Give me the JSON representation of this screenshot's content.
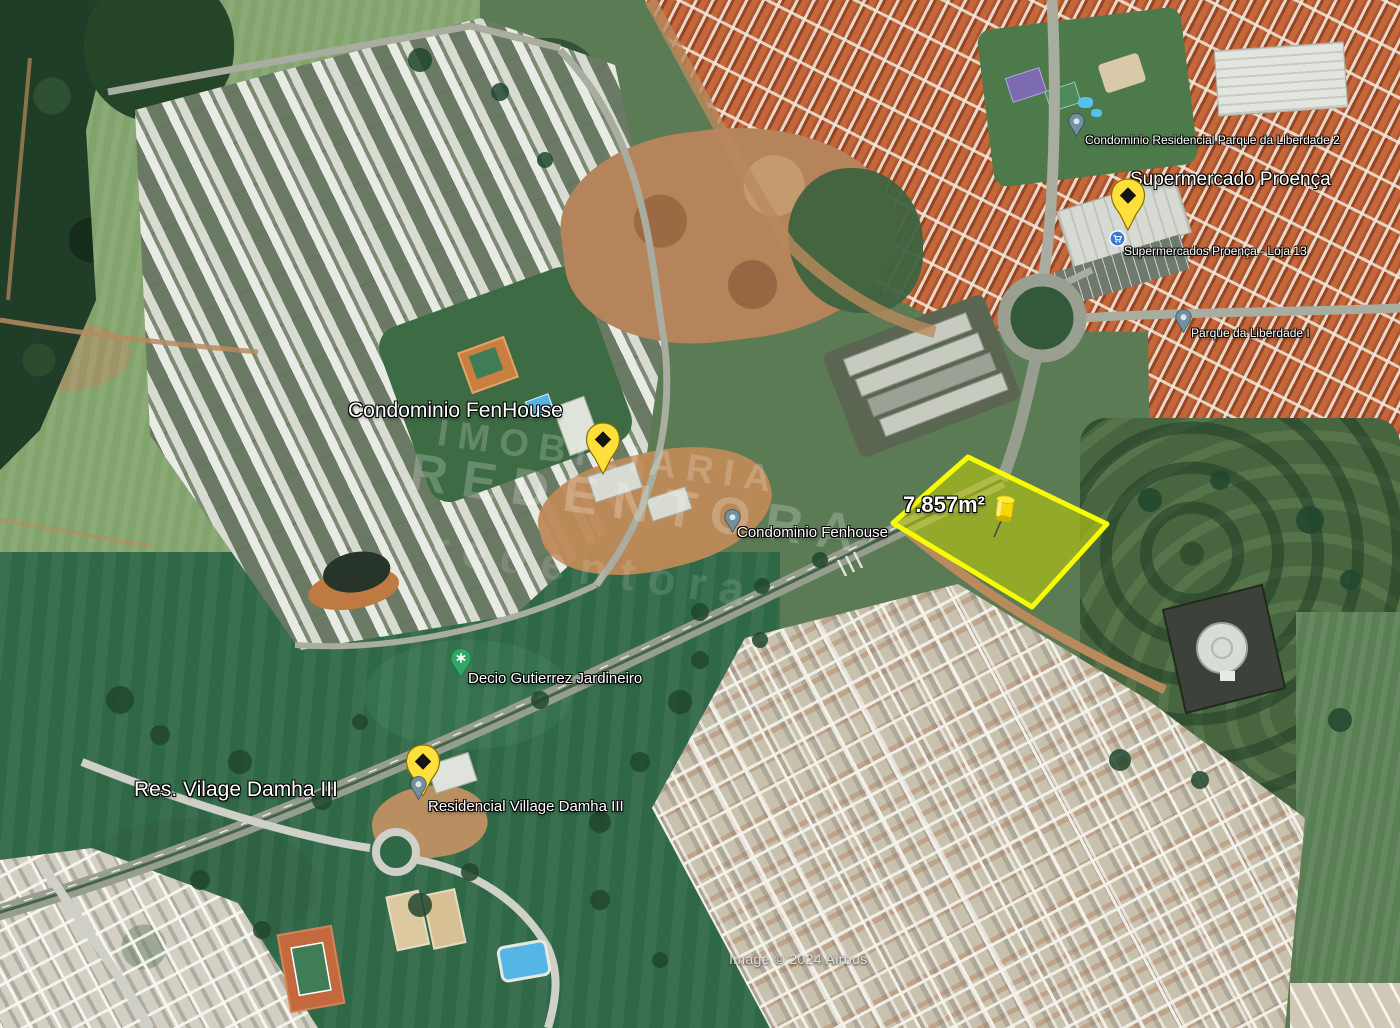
{
  "map": {
    "attribution": "Image © 2024 Airbus",
    "watermark": {
      "line1": "IMOBILIARIA",
      "line2": "REDENTORA",
      "line3": "redentora"
    },
    "parcel": {
      "area_label": "7.857m²",
      "outline_color": "#f7fd00",
      "fill_color": "rgba(204,216,0,0.5)"
    },
    "labels": {
      "fenhouse_main": "Condominio FenHouse",
      "fenhouse_gate": "Condominio Fenhouse",
      "supermercado_main": "Supermercado Proença",
      "supermercado_store": "Supermercados Proença - Loja 13",
      "parque_liberdade_2": "Condominio Residencial Parque da Liberdade 2",
      "parque_liberdade_1": "Parque da Liberdade I",
      "decio": "Decio Gutierrez Jardineiro",
      "village_main": "Res. Vilage Damha III",
      "village_small": "Residencial Village Damha III"
    },
    "colors": {
      "placemark_yellow": "#ffe03a",
      "placemark_outline": "#8a7000",
      "pushpin_yellow": "#f8d800",
      "poi_green": "#34a667",
      "poi_blue": "#3b79d6",
      "poi_slate": "#72909f",
      "label_text": "#ffffff"
    }
  }
}
